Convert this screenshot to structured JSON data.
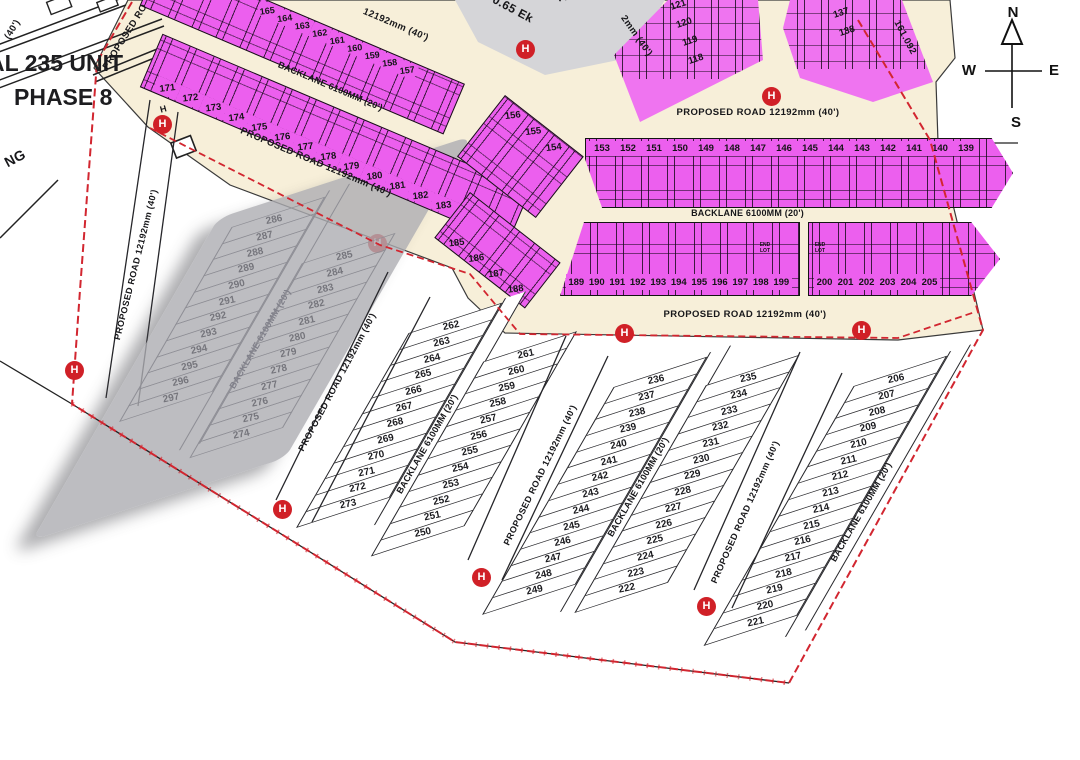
{
  "title": {
    "line1": "AL 235 UNIT",
    "line2": "PHASE 8"
  },
  "compass": {
    "north": "N",
    "east": "E",
    "south": "S",
    "west": "W"
  },
  "labels": {
    "proposed_road": "PROPOSED ROAD 12192mm (40')",
    "backlane": "BACKLANE 6100MM (20')",
    "road_fragment_top": "12192mm (40')",
    "road_fragment_top_center": "2mm (40')",
    "road_fragment_corner": "(40')",
    "road_fragment_left": "PROPOSED RO",
    "text_fragment_ng": "NG",
    "area_line1": "m²",
    "area_line2": "0.65 Ek",
    "dimension": "161.092",
    "hydrant": "H",
    "end_lot": "END LOT"
  },
  "colors": {
    "road_fill": "#f7efd9",
    "lot_magenta": "#ec5fee",
    "lot_magenta_light": "#ef74f0",
    "boundary_red": "#d22630",
    "hydrant_red": "#d02027",
    "gray_block": "#adadb2",
    "line_black": "#1a1a1a"
  },
  "lots": {
    "m1_top_row": [
      "165",
      "164",
      "163",
      "162",
      "161",
      "160",
      "159",
      "158",
      "157"
    ],
    "m1_bottom_row": [
      "171",
      "172",
      "173",
      "174",
      "175",
      "176",
      "177",
      "178",
      "179",
      "180",
      "181",
      "182",
      "183",
      "184"
    ],
    "m1_bend": [
      "185",
      "186",
      "187",
      "188"
    ],
    "corner_block": [
      "156",
      "155",
      "154"
    ],
    "m2_top_row": [
      "153",
      "152",
      "151",
      "150",
      "149",
      "148",
      "147",
      "146",
      "145",
      "144",
      "143",
      "142",
      "141",
      "140",
      "139"
    ],
    "m2_bottom_left": [
      "189",
      "190",
      "191",
      "192",
      "193",
      "194",
      "195",
      "196",
      "197",
      "198",
      "199"
    ],
    "m2_bottom_right": [
      "200",
      "201",
      "202",
      "203",
      "204",
      "205"
    ],
    "m3_block": [
      "121",
      "120",
      "119",
      "118"
    ],
    "m4_block": [
      "136",
      "137",
      "138"
    ],
    "gray_left": [
      "286",
      "287",
      "288",
      "289",
      "290",
      "291",
      "292",
      "293",
      "294",
      "295",
      "296",
      "297"
    ],
    "gray_right": [
      "285",
      "284",
      "283",
      "282",
      "281",
      "280",
      "279",
      "278",
      "277",
      "276",
      "275",
      "274"
    ],
    "stripA_left": [
      "262",
      "263",
      "264",
      "265",
      "266",
      "267",
      "268",
      "269",
      "270",
      "271",
      "272",
      "273"
    ],
    "stripA_right": [
      "261",
      "260",
      "259",
      "258",
      "257",
      "256",
      "255",
      "254",
      "253",
      "252",
      "251",
      "250"
    ],
    "stripB_left": [
      "236",
      "237",
      "238",
      "239",
      "240",
      "241",
      "242",
      "243",
      "244",
      "245",
      "246",
      "247",
      "248",
      "249"
    ],
    "stripB_right": [
      "235",
      "234",
      "233",
      "232",
      "231",
      "230",
      "229",
      "228",
      "227",
      "226",
      "225",
      "224",
      "223",
      "222"
    ],
    "stripC": [
      "206",
      "207",
      "208",
      "209",
      "210",
      "211",
      "212",
      "213",
      "214",
      "215",
      "216",
      "217",
      "218",
      "219",
      "220",
      "221"
    ]
  }
}
